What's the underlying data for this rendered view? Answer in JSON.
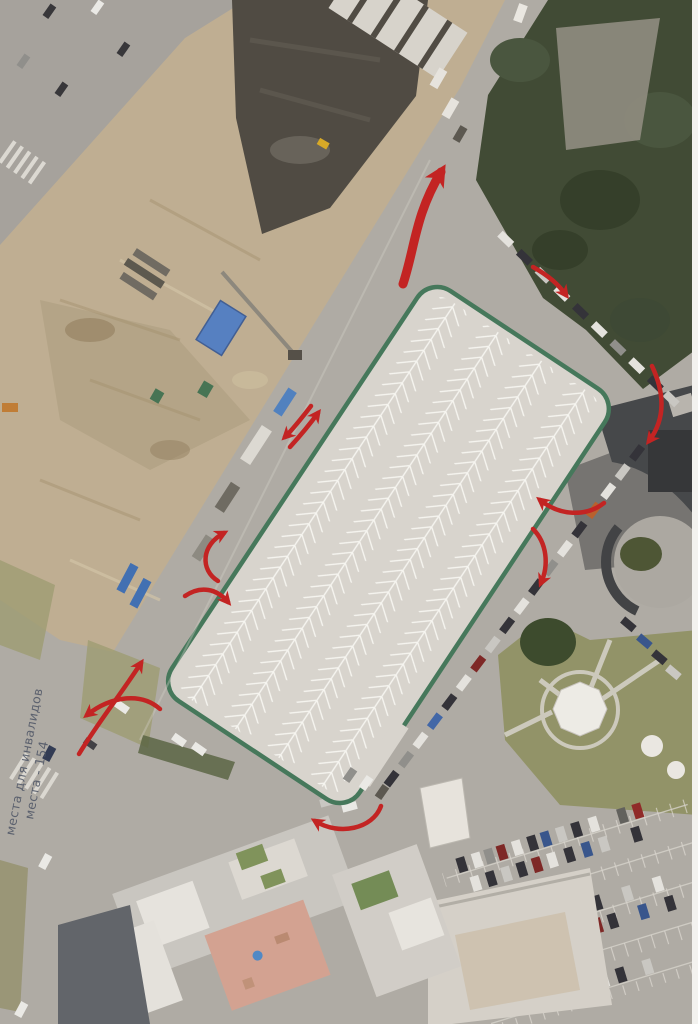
{
  "note": {
    "line1": "места для инвалидов",
    "line2": "места - 154"
  },
  "colors": {
    "arrow": "#c32423",
    "lot_outline": "#3e7458",
    "lot_surface": "#d9d6d1",
    "lot_marking": "#fbfaf7",
    "note_text": "#4a5263"
  },
  "annotations": {
    "arrows": [
      {
        "name": "exit-north-curve",
        "d": "M 403 284 C 415 248 415 215 441 172",
        "width": 9
      },
      {
        "name": "entry-northeast",
        "d": "M 533 267 C 549 276 558 284 566 295",
        "width": 4.5
      },
      {
        "name": "right-upper-inward",
        "d": "M 652 366 C 666 396 664 421 649 441",
        "width": 4.5
      },
      {
        "name": "right-middle-westward",
        "d": "M 604 503 C 586 517 560 516 540 500",
        "width": 4.5
      },
      {
        "name": "right-middle-downward",
        "d": "M 533 529 C 547 543 549 565 541 583",
        "width": 4.5
      },
      {
        "name": "two-way-left-a",
        "d": "M 311 406 C 301 419 293 429 285 437",
        "width": 4.5
      },
      {
        "name": "two-way-left-b",
        "d": "M 290 447 C 300 436 310 424 318 413",
        "width": 4.5
      },
      {
        "name": "west-edge-up-hook",
        "d": "M 218 581 C 200 570 201 545 224 533",
        "width": 4.5
      },
      {
        "name": "west-edge-down-hook",
        "d": "M 185 596 C 201 585 217 589 228 602",
        "width": 4.5
      },
      {
        "name": "southwest-straight",
        "d": "M 79 754 C 97 724 121 694 141 663",
        "width": 4.5
      },
      {
        "name": "southwest-curve-left",
        "d": "M 160 709 C 141 692 111 696 87 715",
        "width": 4.5
      },
      {
        "name": "south-entrance-curve",
        "d": "M 381 806 C 373 829 339 836 315 821",
        "width": 4.5
      }
    ]
  }
}
